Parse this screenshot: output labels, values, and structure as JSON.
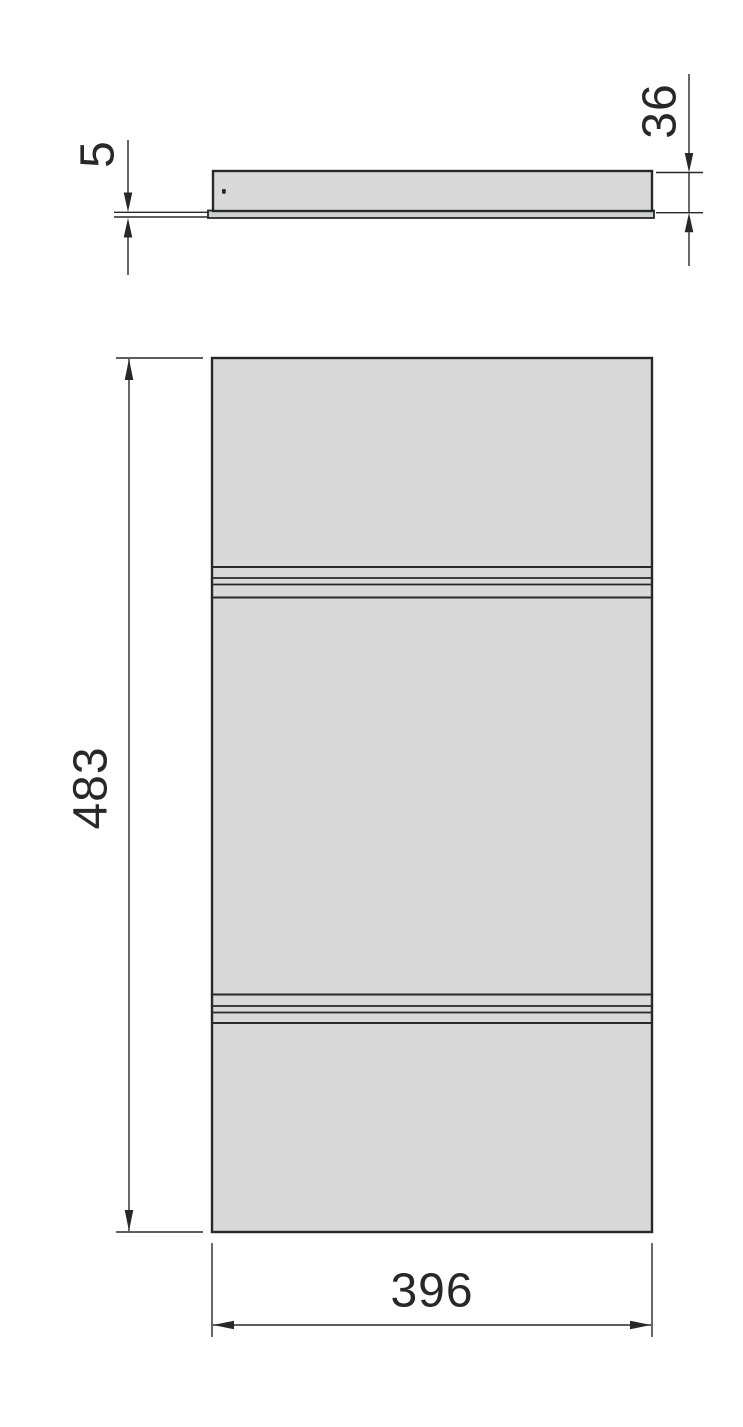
{
  "dimensions": {
    "base_thickness": {
      "label": "5"
    },
    "panel_thickness": {
      "label": "36"
    },
    "panel_height": {
      "label": "483"
    },
    "panel_width": {
      "label": "396"
    }
  },
  "colors": {
    "background": "#ffffff",
    "panel_fill": "#d9d9d9",
    "base_plate_fill": "#cdcfd0",
    "line": "#26282a"
  }
}
